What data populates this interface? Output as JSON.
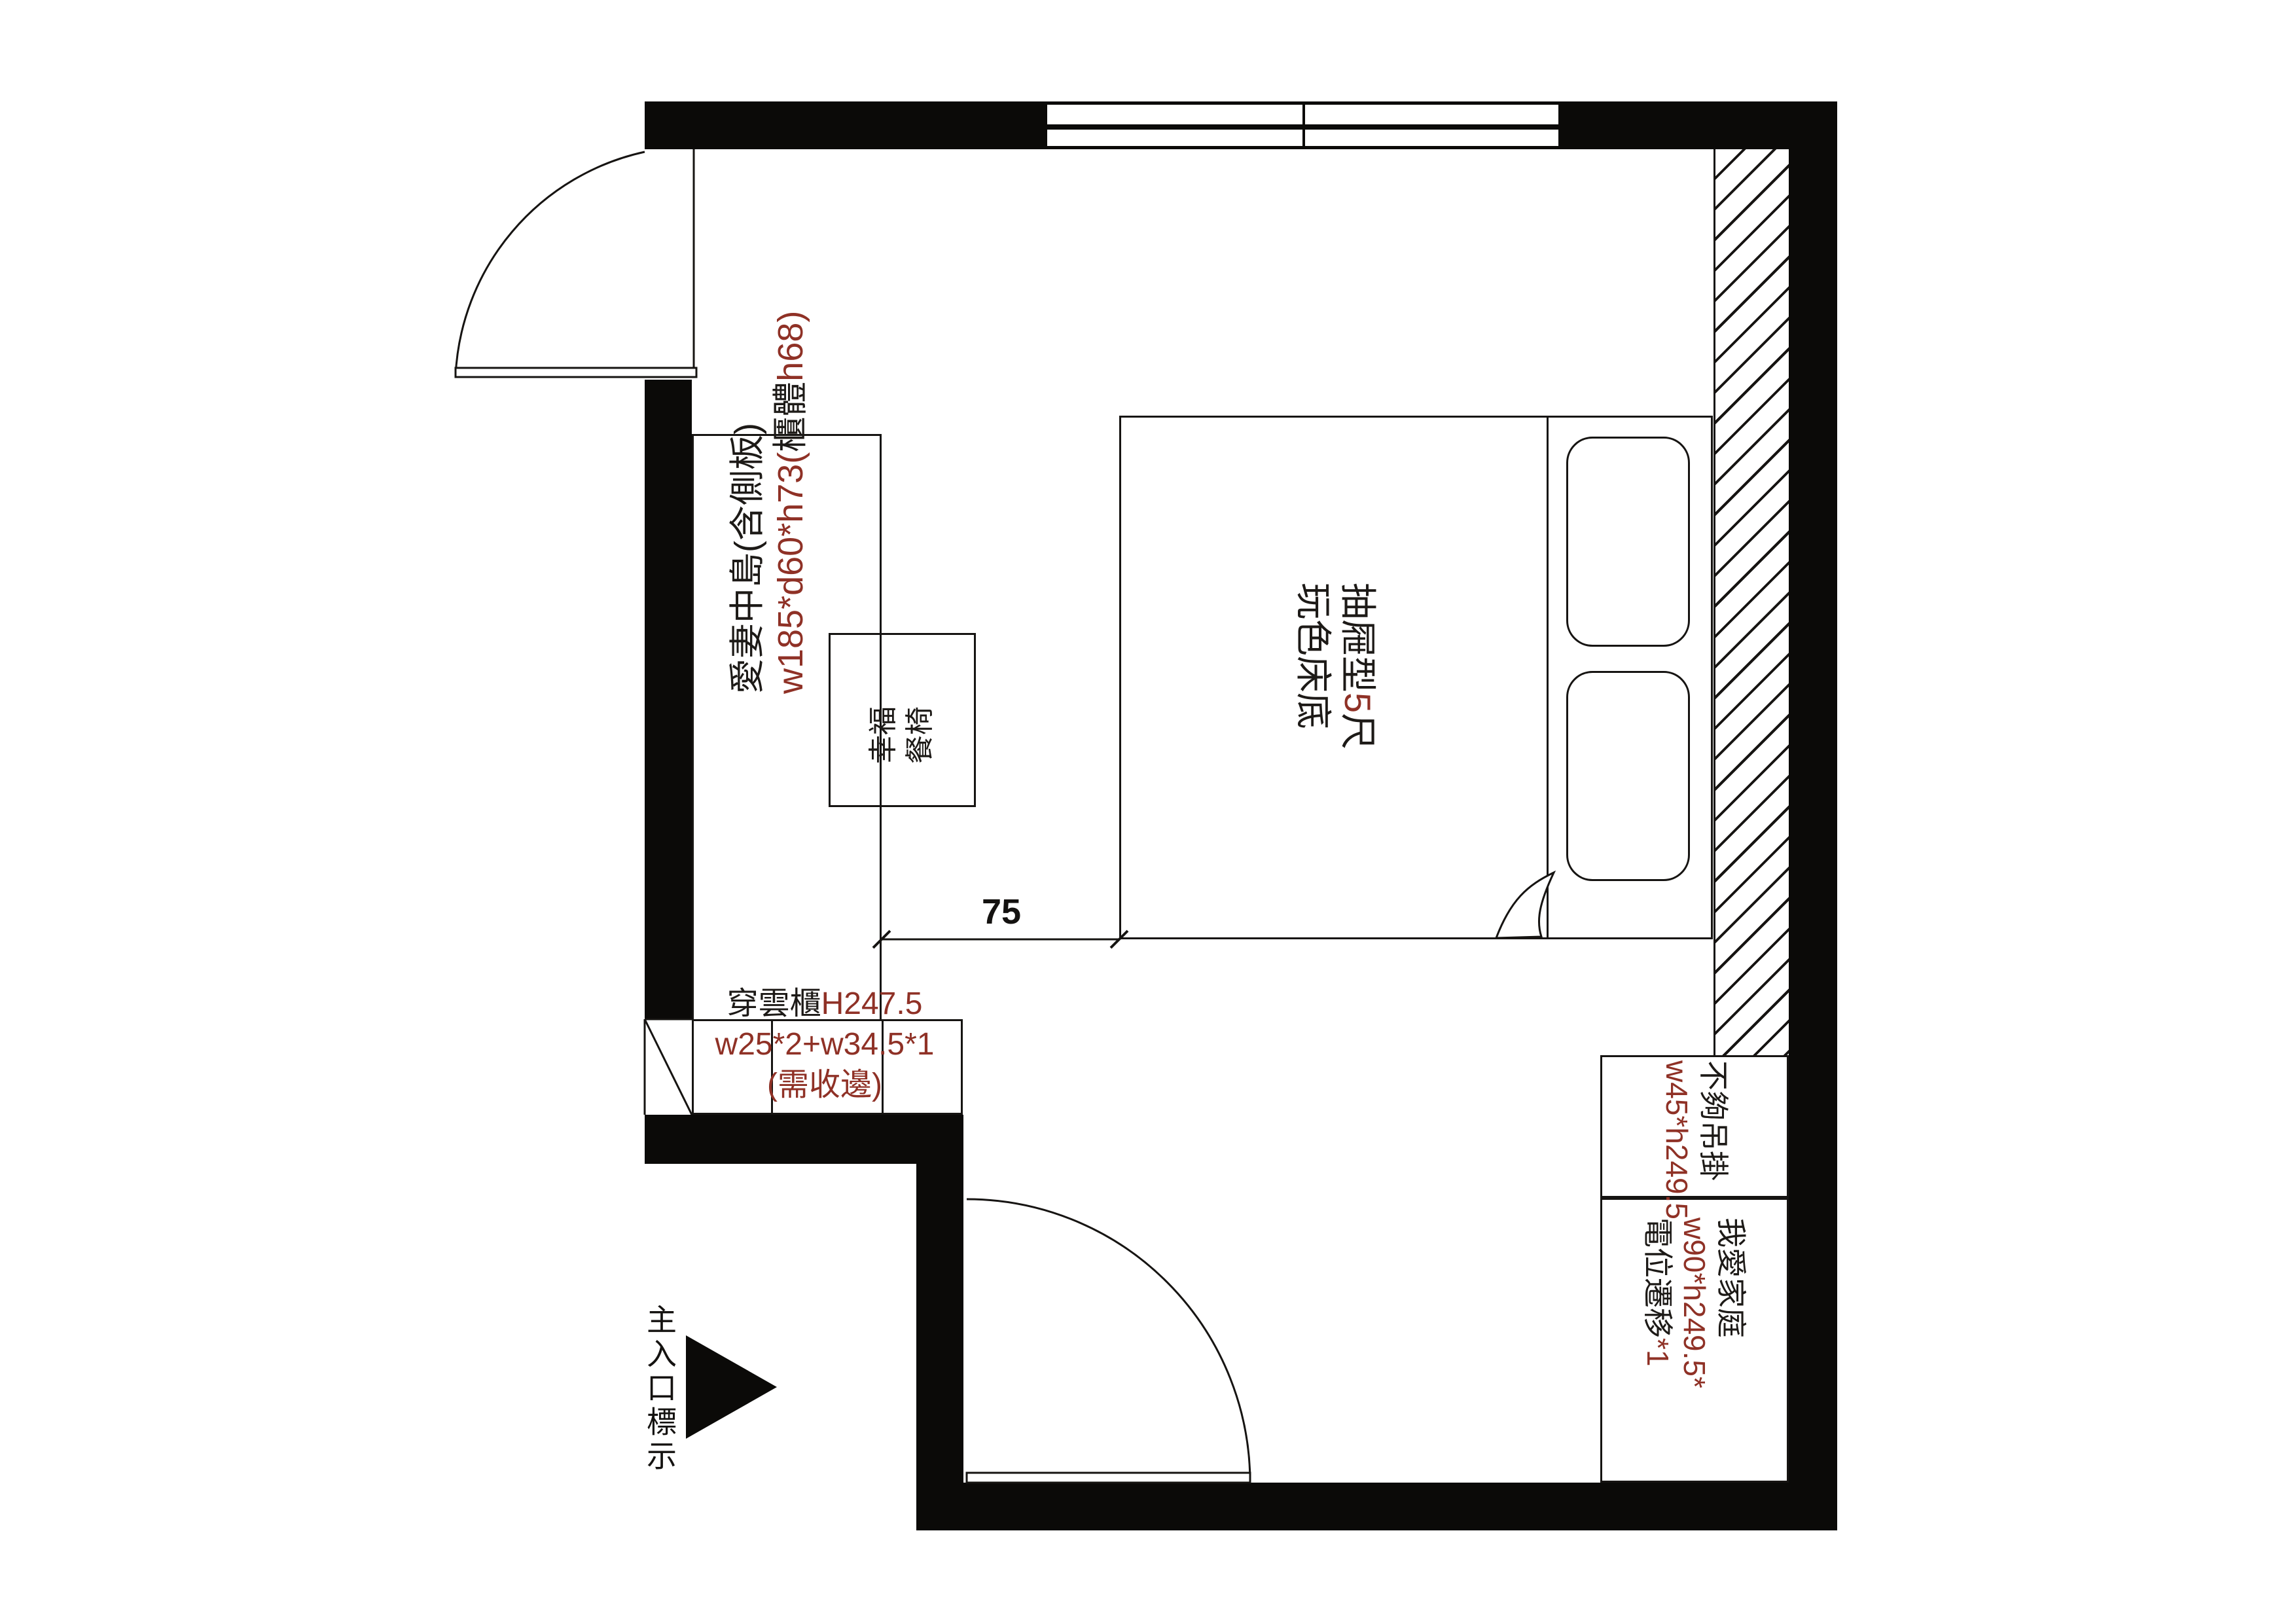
{
  "colors": {
    "wall": "#0b0a08",
    "line": "#161412",
    "accent_red": "#8f3126",
    "text_black": "#1d1a17"
  },
  "labels": {
    "island": {
      "line1": "愛妻中島(含側板)",
      "line2_pre": "w185*d60*h73(",
      "line2_mid": "櫃體",
      "line2_post": "h68)"
    },
    "chair": {
      "line1": "幸福",
      "line2": "餐椅"
    },
    "bed": {
      "line1_pre": "抽屜型",
      "line1_red": "5",
      "line1_post": "尺",
      "line2": "玩色床底"
    },
    "dimension": {
      "value": "75"
    },
    "wardrobe": {
      "line1_black": "穿雲櫃",
      "line1_red": "H247.5",
      "line2": "w25*2+w34.5*1",
      "line3": "(需收邊)"
    },
    "hang_area": {
      "line1": "不夠吊掛",
      "line2": "w45*h249.5"
    },
    "family_cabinet": {
      "line1": "我愛家庭",
      "line2": "w90*h249.5*",
      "line3_black": "電位遷移",
      "line3_red": "*1"
    },
    "entrance": {
      "text": "主入口標示"
    }
  }
}
